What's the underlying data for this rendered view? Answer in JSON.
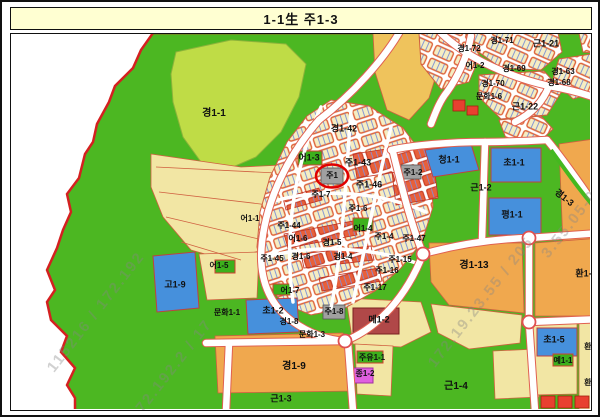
{
  "title": "1-1生 주1-3",
  "map": {
    "colors": {
      "boundary_red": "#D42020",
      "highlight_red": "#E00000",
      "park_green": "#4CB722",
      "zone_orange": "#F0A84E",
      "zone_pale_yellow": "#F2E6A4",
      "school_blue": "#4690DC",
      "title_bg": "#FFFFD2"
    },
    "highlight": {
      "label": "주1",
      "x": 331,
      "y": 174
    },
    "labels": [
      {
        "text": "경1-1",
        "x": 213,
        "y": 112,
        "size": 10
      },
      {
        "text": "경1-42",
        "x": 343,
        "y": 127
      },
      {
        "text": "주1-43",
        "x": 357,
        "y": 161
      },
      {
        "text": "어1-3",
        "x": 308,
        "y": 156
      },
      {
        "text": "주1",
        "x": 331,
        "y": 174,
        "size": 8
      },
      {
        "text": "주1-46",
        "x": 368,
        "y": 183
      },
      {
        "text": "주1-2",
        "x": 412,
        "y": 171,
        "size": 8
      },
      {
        "text": "청1-1",
        "x": 448,
        "y": 158
      },
      {
        "text": "초1-1",
        "x": 513,
        "y": 161
      },
      {
        "text": "근1-2",
        "x": 480,
        "y": 186
      },
      {
        "text": "평1-1",
        "x": 511,
        "y": 213
      },
      {
        "text": "경1-3",
        "x": 563,
        "y": 196,
        "rot": 38
      },
      {
        "text": "경1-72",
        "x": 468,
        "y": 47,
        "size": 8
      },
      {
        "text": "경1-71",
        "x": 501,
        "y": 39,
        "size": 8
      },
      {
        "text": "근1-21",
        "x": 545,
        "y": 42
      },
      {
        "text": "어1-2",
        "x": 474,
        "y": 64,
        "size": 8
      },
      {
        "text": "경1-69",
        "x": 513,
        "y": 67,
        "size": 8
      },
      {
        "text": "경1-63",
        "x": 562,
        "y": 70,
        "size": 8
      },
      {
        "text": "경1-70",
        "x": 492,
        "y": 82,
        "size": 8
      },
      {
        "text": "경1-68",
        "x": 558,
        "y": 81,
        "size": 8
      },
      {
        "text": "문화1-6",
        "x": 488,
        "y": 95,
        "size": 8
      },
      {
        "text": "근1-22",
        "x": 524,
        "y": 105
      },
      {
        "text": "주1-7",
        "x": 320,
        "y": 193,
        "size": 8
      },
      {
        "text": "어1-1",
        "x": 249,
        "y": 217,
        "size": 8
      },
      {
        "text": "주1-44",
        "x": 288,
        "y": 224,
        "size": 8
      },
      {
        "text": "어1-6",
        "x": 297,
        "y": 237,
        "size": 8
      },
      {
        "text": "주1-45",
        "x": 271,
        "y": 257,
        "size": 8
      },
      {
        "text": "경1-6",
        "x": 300,
        "y": 255,
        "size": 8
      },
      {
        "text": "경1-5",
        "x": 331,
        "y": 241,
        "size": 8
      },
      {
        "text": "경1-4",
        "x": 342,
        "y": 255,
        "size": 8
      },
      {
        "text": "주1-6",
        "x": 357,
        "y": 207,
        "size": 8
      },
      {
        "text": "어1-4",
        "x": 362,
        "y": 227,
        "size": 8
      },
      {
        "text": "주1-4",
        "x": 383,
        "y": 235,
        "size": 8
      },
      {
        "text": "주1-47",
        "x": 413,
        "y": 237,
        "size": 8
      },
      {
        "text": "주1-15",
        "x": 399,
        "y": 258,
        "size": 8
      },
      {
        "text": "주1-16",
        "x": 386,
        "y": 269,
        "size": 8
      },
      {
        "text": "주1-17",
        "x": 374,
        "y": 286,
        "size": 8
      },
      {
        "text": "어1-7",
        "x": 289,
        "y": 289,
        "size": 8
      },
      {
        "text": "어1-5",
        "x": 218,
        "y": 264,
        "size": 8
      },
      {
        "text": "고1-9",
        "x": 174,
        "y": 283
      },
      {
        "text": "문화1-1",
        "x": 226,
        "y": 311,
        "size": 8
      },
      {
        "text": "초1-2",
        "x": 272,
        "y": 309
      },
      {
        "text": "경1-8",
        "x": 288,
        "y": 320,
        "size": 8
      },
      {
        "text": "문화1-3",
        "x": 311,
        "y": 333,
        "size": 8
      },
      {
        "text": "주1-8",
        "x": 333,
        "y": 310,
        "size": 8
      },
      {
        "text": "메1-2",
        "x": 378,
        "y": 318
      },
      {
        "text": "주유1-1",
        "x": 371,
        "y": 356,
        "size": 8
      },
      {
        "text": "종1-2",
        "x": 364,
        "y": 372,
        "size": 8
      },
      {
        "text": "경1-9",
        "x": 293,
        "y": 365,
        "size": 10
      },
      {
        "text": "근1-3",
        "x": 280,
        "y": 397
      },
      {
        "text": "근1-4",
        "x": 455,
        "y": 385,
        "size": 10
      },
      {
        "text": "경1-13",
        "x": 473,
        "y": 264,
        "size": 10
      },
      {
        "text": "환1-6",
        "x": 585,
        "y": 272
      },
      {
        "text": "초1-5",
        "x": 553,
        "y": 338
      },
      {
        "text": "환1",
        "x": 589,
        "y": 345,
        "size": 8
      },
      {
        "text": "예1-1",
        "x": 562,
        "y": 359,
        "size": 8
      },
      {
        "text": "환1",
        "x": 589,
        "y": 381,
        "size": 8
      }
    ],
    "watermarks": [
      {
        "text": "115216 / 172.192",
        "x": 95,
        "y": 310,
        "rot": -52
      },
      {
        "text": "172.192.2 / 17",
        "x": 170,
        "y": 368,
        "rot": -52
      },
      {
        "text": "172.19.23.55 / 205",
        "x": 480,
        "y": 300,
        "rot": -52
      },
      {
        "text": "3.55.05-06",
        "x": 572,
        "y": 218,
        "rot": -52
      }
    ]
  }
}
